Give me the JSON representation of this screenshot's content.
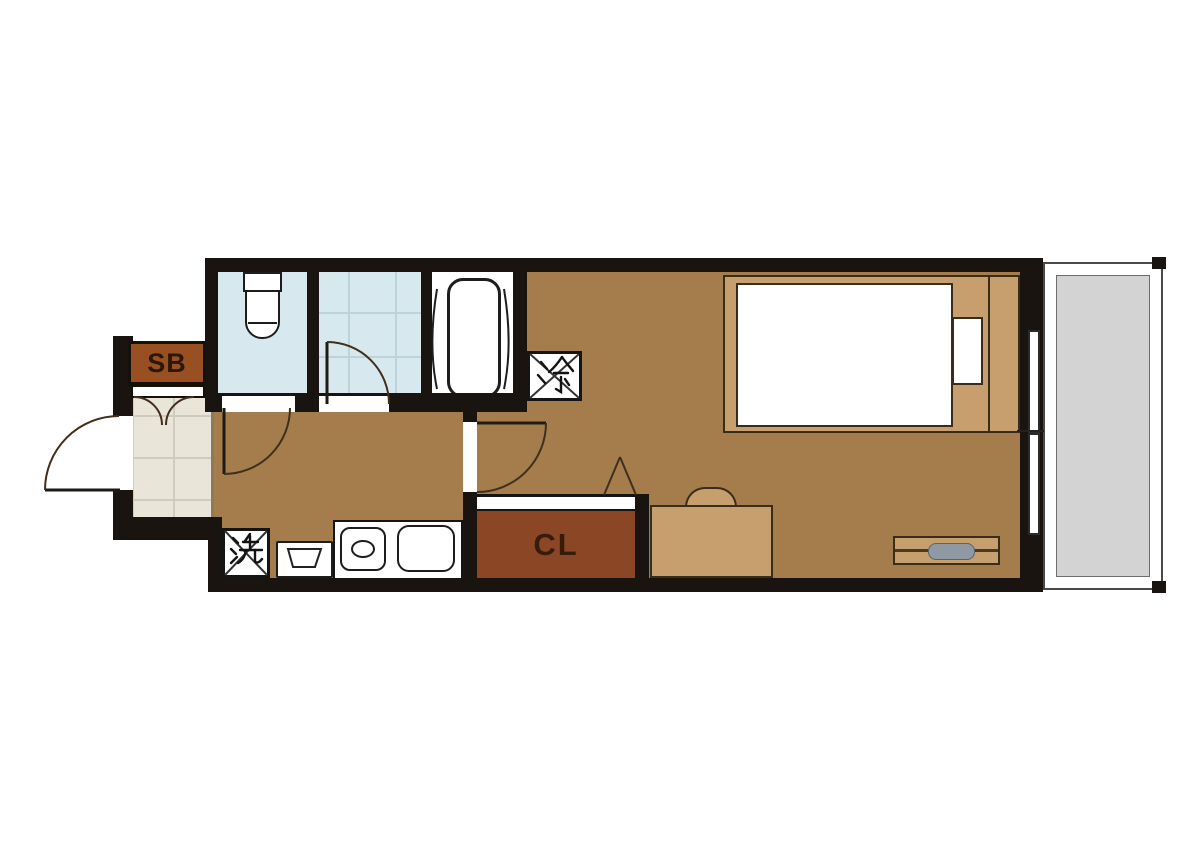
{
  "floorplan": {
    "labels": {
      "shoe_box": "SB",
      "closet": "CL",
      "refrigerator": "冷",
      "washer": "洗"
    },
    "colors": {
      "wall": "#191410",
      "room_floor": "#a57c4c",
      "furniture_tan": "#c79e6e",
      "furniture_outline": "#3a2c1a",
      "closet_brown": "#8b4625",
      "shoebox_brown": "#985022",
      "wet_blue": "#d7e8ee",
      "entrance_tile": "#e9e5d9",
      "balcony_gray": "#d3d3d3",
      "tv_gray": "#8f99a3",
      "label_dark": "#2b180a",
      "line_dark": "#3f2f1c"
    }
  }
}
